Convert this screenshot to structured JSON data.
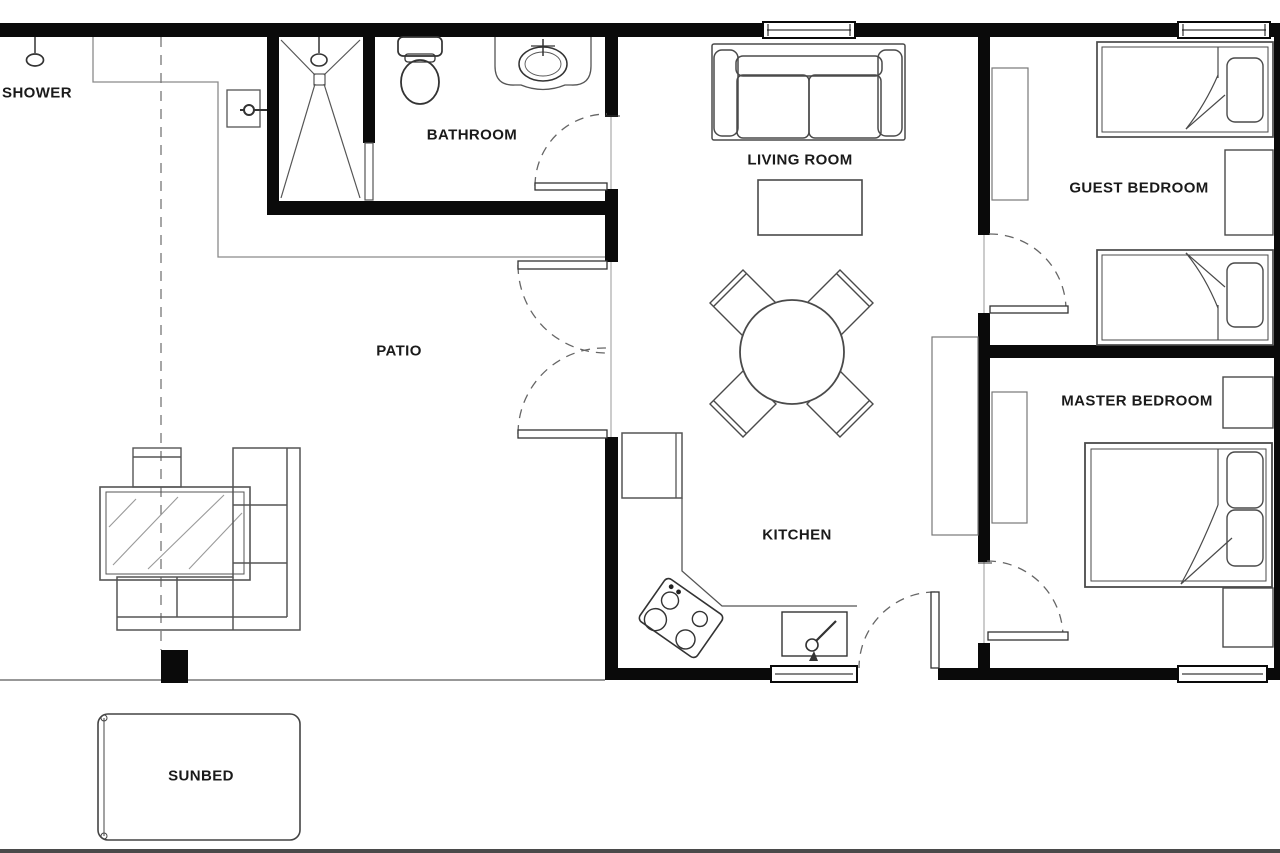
{
  "plan_title": "Apartment Floor Plan",
  "rooms": [
    {
      "id": "shower",
      "label": "SHOWER"
    },
    {
      "id": "bathroom",
      "label": "BATHROOM"
    },
    {
      "id": "patio",
      "label": "PATIO"
    },
    {
      "id": "living-room",
      "label": "LIVING ROOM"
    },
    {
      "id": "kitchen",
      "label": "KITCHEN"
    },
    {
      "id": "guest-bedroom",
      "label": "GUEST BEDROOM"
    },
    {
      "id": "master-bedroom",
      "label": "MASTER BEDROOM"
    },
    {
      "id": "sunbed",
      "label": "SUNBED"
    }
  ],
  "colors": {
    "wall": "#0a0a0a",
    "furniture_line": "#4a4a4a",
    "fixture_line": "#333333",
    "light_line": "#8a8a8a",
    "door_arc": "#666666",
    "background": "#ffffff",
    "label_text": "#1a1a1a"
  },
  "symbols": [
    "shower-head-icon",
    "shower-drain-icon",
    "toilet-icon",
    "vanity-sink-icon",
    "sofa-icon",
    "coffee-table-icon",
    "dining-table-icon",
    "dining-chair-icon",
    "stove-icon",
    "kitchen-sink-icon",
    "faucet-icon",
    "wardrobe-icon",
    "single-bed-icon",
    "double-bed-icon",
    "pillow-icon",
    "nightstand-icon",
    "window-icon",
    "door-swing-icon",
    "glass-table-icon",
    "sectional-sofa-icon",
    "stool-icon",
    "post-icon",
    "sunbed-icon",
    "shower-valve-icon"
  ]
}
